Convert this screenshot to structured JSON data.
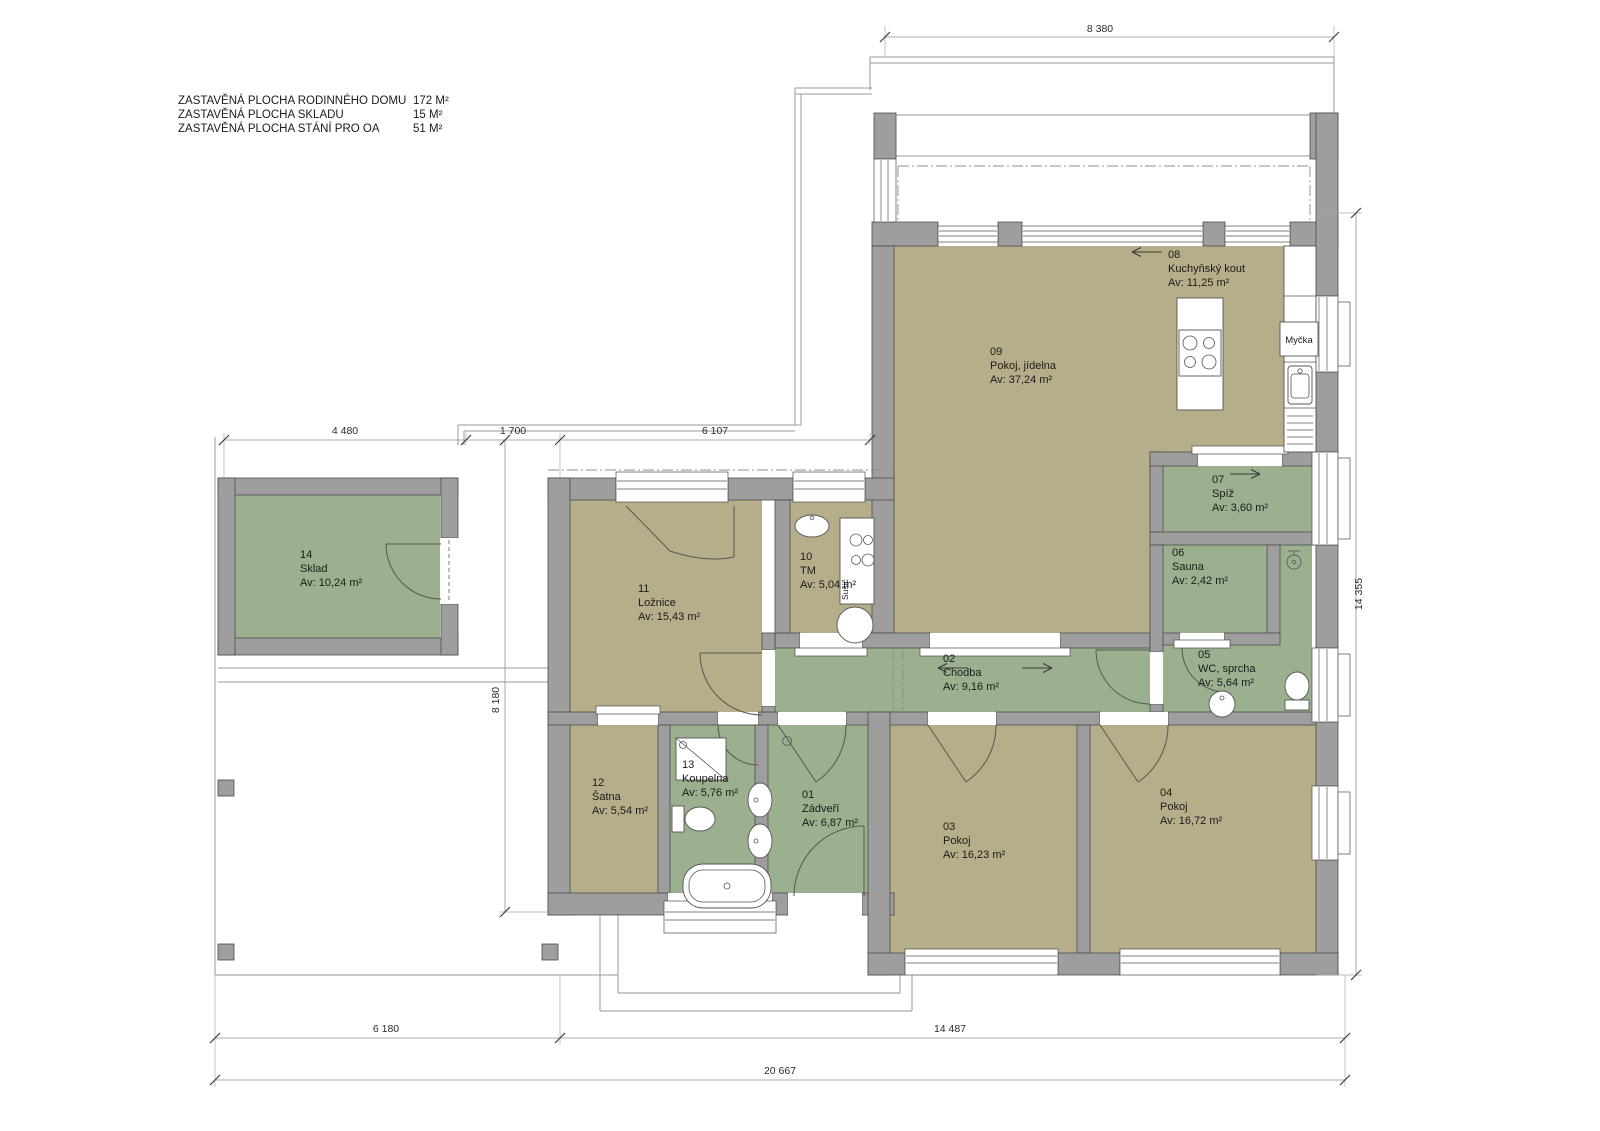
{
  "title": "Floor plan – rodinný dům (family house ground plan)",
  "legend": {
    "rows": [
      {
        "label": "ZASTAVĚNÁ PLOCHA RODINNÉHO DOMU",
        "value": "172 M²"
      },
      {
        "label": "ZASTAVĚNÁ PLOCHA SKLADU",
        "value": "15 M²"
      },
      {
        "label": "ZASTAVĚNÁ PLOCHA STÁNÍ PRO OA",
        "value": "51 M²"
      }
    ]
  },
  "rooms": {
    "r01": {
      "num": "01",
      "name": "Zádveří",
      "area": "Av: 6,87 m²"
    },
    "r02": {
      "num": "02",
      "name": "Chodba",
      "area": "Av: 9,16 m²"
    },
    "r03": {
      "num": "03",
      "name": "Pokoj",
      "area": "Av: 16,23 m²"
    },
    "r04": {
      "num": "04",
      "name": "Pokoj",
      "area": "Av: 16,72 m²"
    },
    "r05": {
      "num": "05",
      "name": "WC, sprcha",
      "area": "Av: 5,64 m²"
    },
    "r06": {
      "num": "06",
      "name": "Sauna",
      "area": "Av: 2,42 m²"
    },
    "r07": {
      "num": "07",
      "name": "Spíž",
      "area": "Av: 3,60 m²"
    },
    "r08": {
      "num": "08",
      "name": "Kuchyňský kout",
      "area": "Av: 11,25 m²"
    },
    "r09": {
      "num": "09",
      "name": "Pokoj, jídelna",
      "area": "Av: 37,24 m²"
    },
    "r10": {
      "num": "10",
      "name": "TM",
      "area": "Av: 5,04 m²"
    },
    "r11": {
      "num": "11",
      "name": "Ložnice",
      "area": "Av: 15,43 m²"
    },
    "r12": {
      "num": "12",
      "name": "Šatna",
      "area": "Av: 5,54 m²"
    },
    "r13": {
      "num": "13",
      "name": "Koupelna",
      "area": "Av: 5,76 m²"
    },
    "r14": {
      "num": "14",
      "name": "Sklad",
      "area": "Av: 10,24 m²"
    }
  },
  "fixtures": {
    "dishwasher": "Myčka",
    "dryer": "Sušič"
  },
  "dimensions": {
    "top": "8 380",
    "mid_left": "4 480",
    "mid_center": "1 700",
    "mid_right": "6 107",
    "left_vertical": "8 180",
    "right_vertical": "14 355",
    "bottom_left": "6 180",
    "bottom_right": "14 487",
    "bottom_total": "20 667"
  },
  "colors": {
    "wall": "#9e9e9e",
    "room_tan": "#b6ad8a",
    "room_green": "#9bb08f",
    "background": "#ffffff"
  }
}
